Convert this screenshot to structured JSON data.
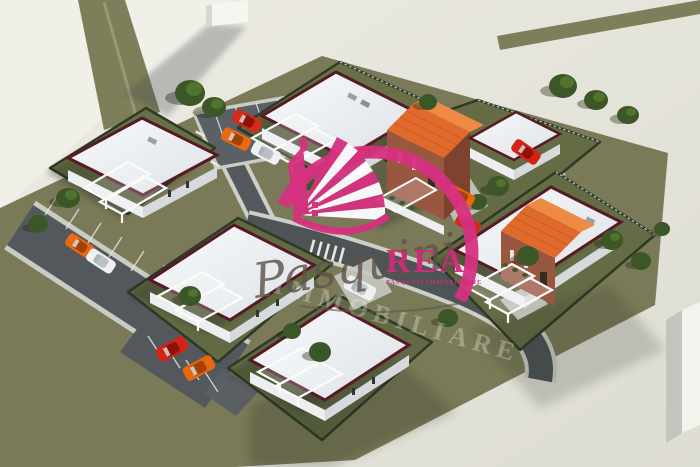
{
  "meta": {
    "type": "architectural-3d-render",
    "description": "Aerial 3D rendering of a small residential development: six modern villas with white flat roofs (two with orange tiled gables), landscaped gardens, internal roads and striped parking areas with cars, on an olive-green site surrounded by pale pavement."
  },
  "watermark": {
    "script_text": "Pasquini",
    "caps_text": "REA",
    "tagline": "PASQUINI IMMOBILIARE",
    "background_text": "IMMOBILIARE",
    "accent_color": "#d6317f"
  },
  "scene": {
    "colors": {
      "site_ground": "#7b7a58",
      "pavement": "#e9e8e0",
      "road": "#53585c",
      "roof_white": "#f4f6f7",
      "roof_trim_maroon": "#571a25",
      "roof_orange": "#e06a2b",
      "brick": "#9a5740",
      "tree_green": "#3c5727"
    },
    "houses": [
      {
        "id": "villa-1",
        "roof": "flat-white",
        "position": "north-west"
      },
      {
        "id": "villa-2",
        "roof": "flat-white",
        "position": "north-center"
      },
      {
        "id": "villa-3",
        "roof": "orange-gable",
        "position": "north-east"
      },
      {
        "id": "villa-4",
        "roof": "flat-white",
        "position": "south-west"
      },
      {
        "id": "villa-5",
        "roof": "flat-white",
        "position": "south-center"
      },
      {
        "id": "villa-6",
        "roof": "orange-gable",
        "position": "east"
      }
    ],
    "cars": [
      {
        "color": "red",
        "location": "top-parking"
      },
      {
        "color": "orange",
        "location": "top-parking"
      },
      {
        "color": "white",
        "location": "top-parking"
      },
      {
        "color": "orange",
        "location": "west-parking"
      },
      {
        "color": "white",
        "location": "west-parking"
      },
      {
        "color": "red",
        "location": "south-parking-bay"
      },
      {
        "color": "orange",
        "location": "south-parking-bay"
      },
      {
        "color": "orange",
        "location": "villa-3-entrance"
      },
      {
        "color": "red",
        "location": "villa-3-gate"
      },
      {
        "color": "red",
        "location": "east-driveway"
      },
      {
        "color": "white",
        "location": "villa-4-driveway"
      }
    ],
    "other": [
      "white monolith building casting long shadow (top-left)",
      "white cube building (bottom-right edge)",
      "about 19 trees",
      "zebra crossings on internal road"
    ]
  }
}
